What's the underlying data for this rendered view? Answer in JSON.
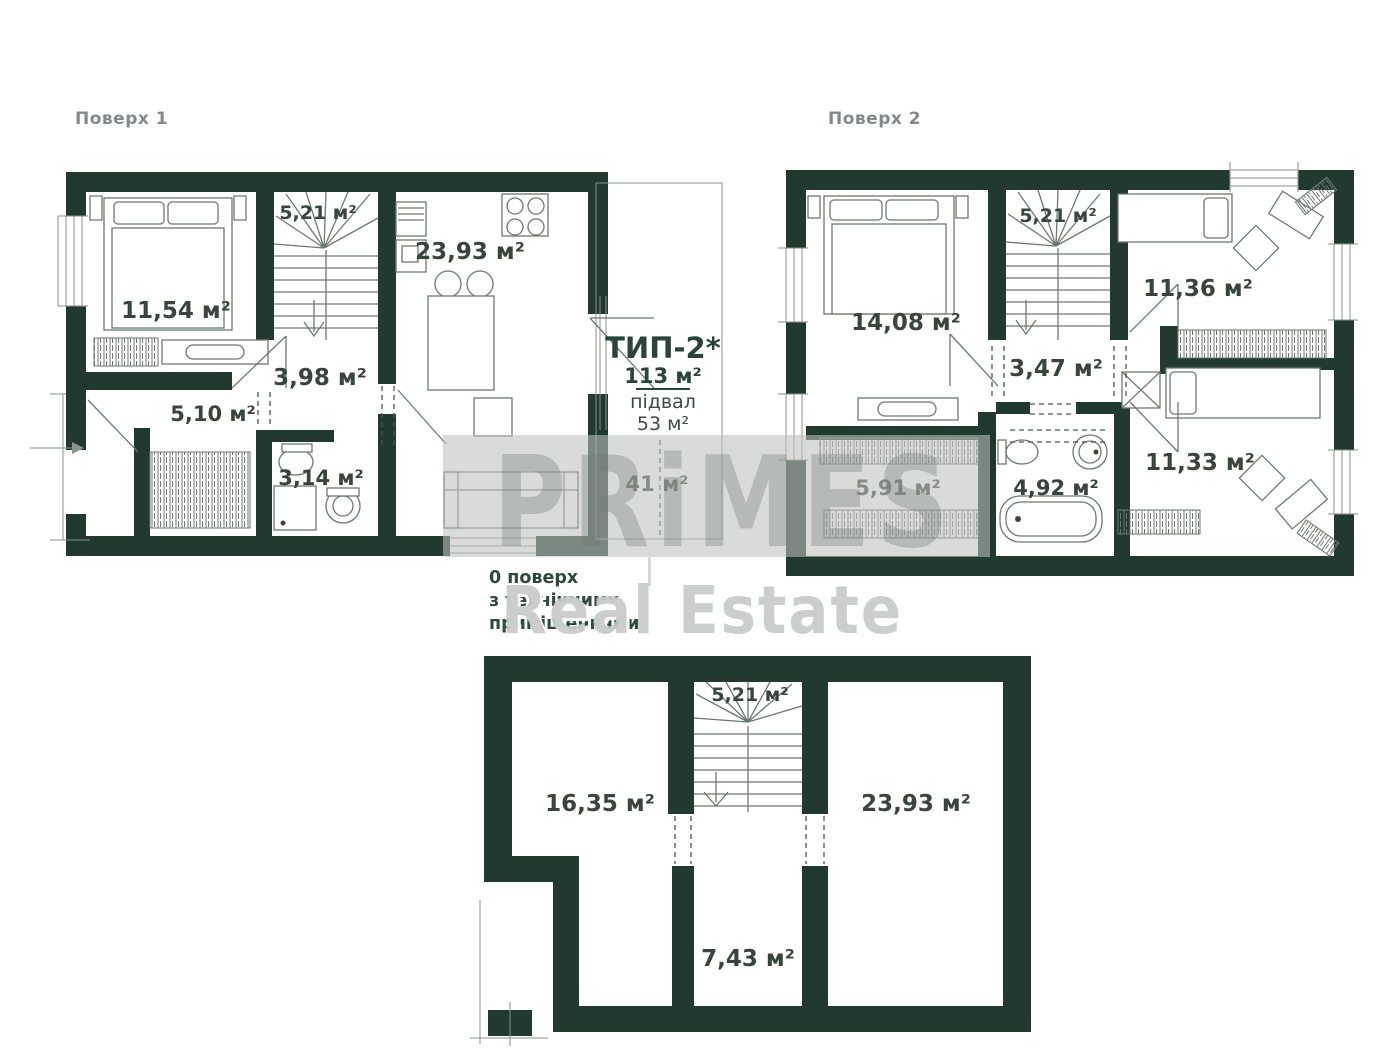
{
  "header": {
    "floor1": "Поверх 1",
    "floor2": "Поверх 2"
  },
  "type_block": {
    "title": "ТИП-2*",
    "total_area": "113 м²",
    "basement_label": "підвал",
    "basement_area": "53 м²"
  },
  "floor1": {
    "rooms": {
      "bedroom": "11,54 м²",
      "stairs": "5,21 м²",
      "kitchen": "23,93 м²",
      "hall": "3,98 м²",
      "wardrobe": "5,10 м²",
      "bathroom": "3,14 м²",
      "terrace": "41 м²"
    }
  },
  "floor2": {
    "rooms": {
      "bedroom": "14,08 м²",
      "stairs": "5,21 м²",
      "child1": "11,36 м²",
      "hall": "3,47 м²",
      "wardrobe": "5,91 м²",
      "bathroom": "4,92 м²",
      "child2": "11,33 м²"
    }
  },
  "basement": {
    "note": [
      "0 поверх",
      "з технічними",
      "приміщеннями"
    ],
    "rooms": {
      "stairs": "5,21 м²",
      "storage1": "16,35 м²",
      "storage2": "23,93 м²",
      "hall": "7,43 м²"
    }
  },
  "watermark": {
    "brand": "PRiMES",
    "caption": "Real Estate"
  },
  "colors": {
    "wall": "#21392e",
    "label": "#39443d",
    "heading": "#82898d",
    "accent": "#29443a",
    "watermark_gray": "#c7cac9"
  }
}
